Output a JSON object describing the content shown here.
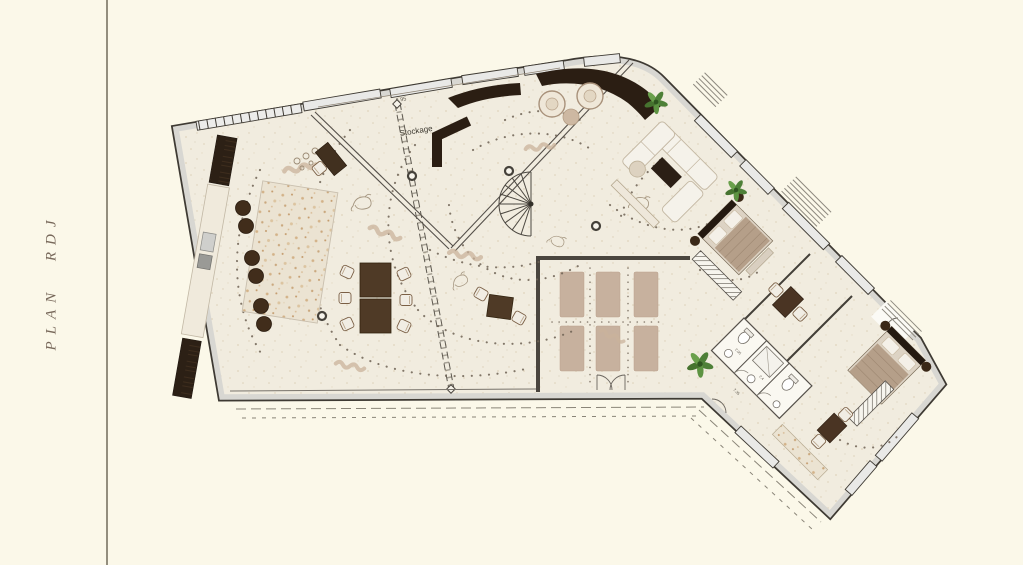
{
  "sidebar": {
    "title": "PLAN RDJ"
  },
  "plan": {
    "labels": {
      "storage": "Stockage",
      "storage_dim": "6.95",
      "bath_dim_1": "2.05",
      "bath_dim_2": "2.4",
      "entry_dim": "7.35"
    },
    "rooms": [
      "storage",
      "main-open-space",
      "kitchen-bar",
      "yoga-room",
      "living-room",
      "bedroom-1",
      "bathrooms",
      "bedroom-2"
    ],
    "furniture": [
      "bar-counter",
      "bar-stools",
      "kitchen-counter",
      "dining-table",
      "lounge-chairs",
      "spiral-staircase",
      "yoga-mats",
      "sofa-set",
      "coffee-table",
      "double-bed-1",
      "double-bed-2",
      "desks",
      "wardrobes",
      "plants"
    ],
    "colors": {
      "background": "#fbf8e9",
      "floor": "#f1ecdf",
      "wall_fill": "#d8d7d2",
      "wall_line": "#3e3a33",
      "dark_wood": "#2c2015",
      "mat": "#c7b19e",
      "plant": "#4e8038",
      "dot_trail": "#6e6254",
      "divider": "#938e7e",
      "title_text": "#77685a"
    }
  }
}
